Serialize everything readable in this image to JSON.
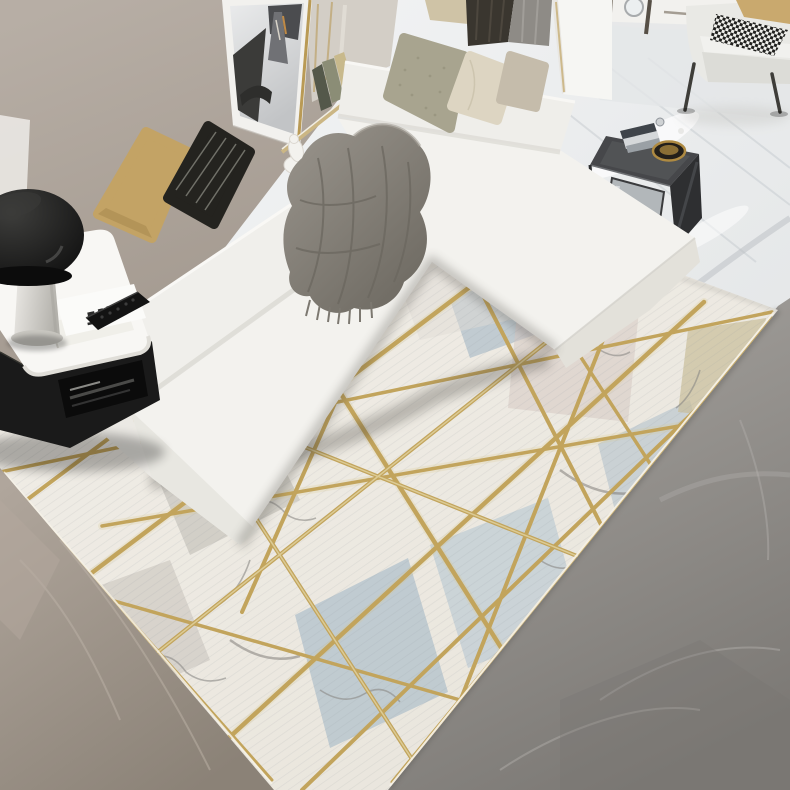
{
  "meta": {
    "domain": "Natural-Image",
    "description": "Bright modern living room: white L-shaped sectional sofa with throw pillows and a gray fringed blanket, leaning black-and-white Paris artwork on a taupe wall, black mushroom lamp on a white side table with magazine and remote, dark C-shaped metal sofa table with books and a brass bowl, white armchair with houndstooth throw, and a large geometric marble-pattern rug criss-crossed by gold lines over gray marble flooring."
  },
  "objects": {
    "wall": "taupe accent wall",
    "artwork": "leaning black-and-white Paris print in gold frame",
    "shelf": "wall ledge with books and white sculpture",
    "curtain_dark": "dark curtain",
    "curtain_gray": "gray curtain",
    "pillar": "white wall pillar",
    "sofa": "white L-shaped sectional sofa",
    "pillow_tan": "tan throw pillow",
    "pillow_striped": "black striped throw pillow",
    "pillow_sage": "sage textured pillow",
    "pillow_cream": "cream pillow",
    "pillow_beige": "beige pillow",
    "pillow_gray": "gray-beige pillow",
    "blanket": "gray fringed throw blanket",
    "side_table_white": "white side table with black base",
    "lamp": "black mushroom table lamp",
    "magazine": "magazine with remote control",
    "c_table": "dark C-shaped sofa table with books and brass bowl",
    "armchair": "white lounge chair with houndstooth throw",
    "rug": "geometric marble rug with gold lines",
    "floor_left": "warm gray marble floor",
    "floor_right": "dark gray marble floor",
    "floor_white": "polished white marble floor"
  },
  "colors": {
    "sofa_white": "#f3f2ee",
    "sofa_back": "#f0efeb",
    "chaise_back": "#efeeea",
    "armrest": "#ebe9e4",
    "pillow_tan": "#c3a365",
    "pillow_black": "#24231f",
    "pillow_sage": "#a8a48f",
    "pillow_cream": "#ddd5c2",
    "pillow_beige": "#cfc3a6",
    "pillow_gray": "#c5bcab",
    "curtain_dark": "#3a362f",
    "curtain_gray": "#8e8b86",
    "pillar_white": "#f6f6f3",
    "table_black": "#1a1a1a",
    "table_top_white": "#f8f7f4",
    "ctable_top": "#46474a",
    "ctable_side": "#2e2f31",
    "mirror_shelf": "#b2b7ba",
    "rug_gold": "#c2a45c",
    "rug_blue": "#b9c6ce",
    "rug_blue2": "#c3ced4",
    "rug_blue3": "#b5c3cc",
    "rug_blue4": "#bfcad0",
    "rug_pink": "#d6c9c3",
    "rug_olive": "#c9bd9a",
    "armchair_white": "#e9e9e5",
    "armchair_tan": "#c9a96e",
    "bowl_brass": "#ae8a42",
    "art_matte": "#f2f1ee"
  }
}
